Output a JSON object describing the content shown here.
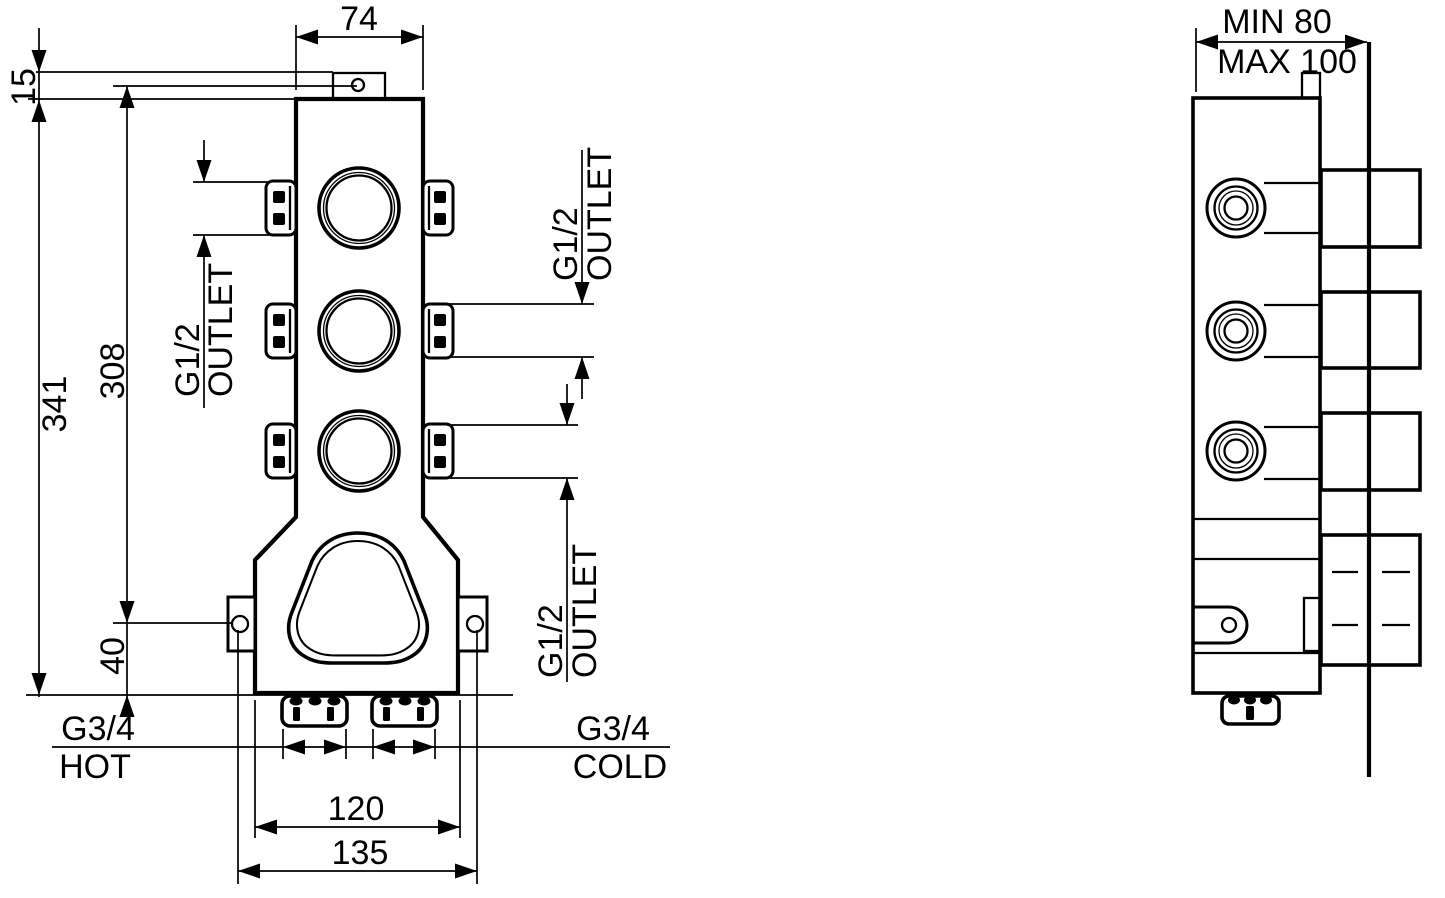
{
  "front_view": {
    "dim_top_width": "74",
    "dim_tab_offset": "15",
    "dim_total_height": "341",
    "dim_outlet_span": "308",
    "dim_ear_to_base": "40",
    "dim_base_width": "120",
    "dim_ear_spacing": "135",
    "outlet_top": {
      "thread": "G1/2",
      "label": "OUTLET"
    },
    "outlet_middle": {
      "thread": "G1/2",
      "label": "OUTLET"
    },
    "outlet_bottom": {
      "thread": "G1/2",
      "label": "OUTLET"
    },
    "inlet_hot": {
      "thread": "G3/4",
      "label": "HOT"
    },
    "inlet_cold": {
      "thread": "G3/4",
      "label": "COLD"
    }
  },
  "side_view": {
    "dim_depth_min": "MIN 80",
    "dim_depth_max": "MAX 100"
  }
}
